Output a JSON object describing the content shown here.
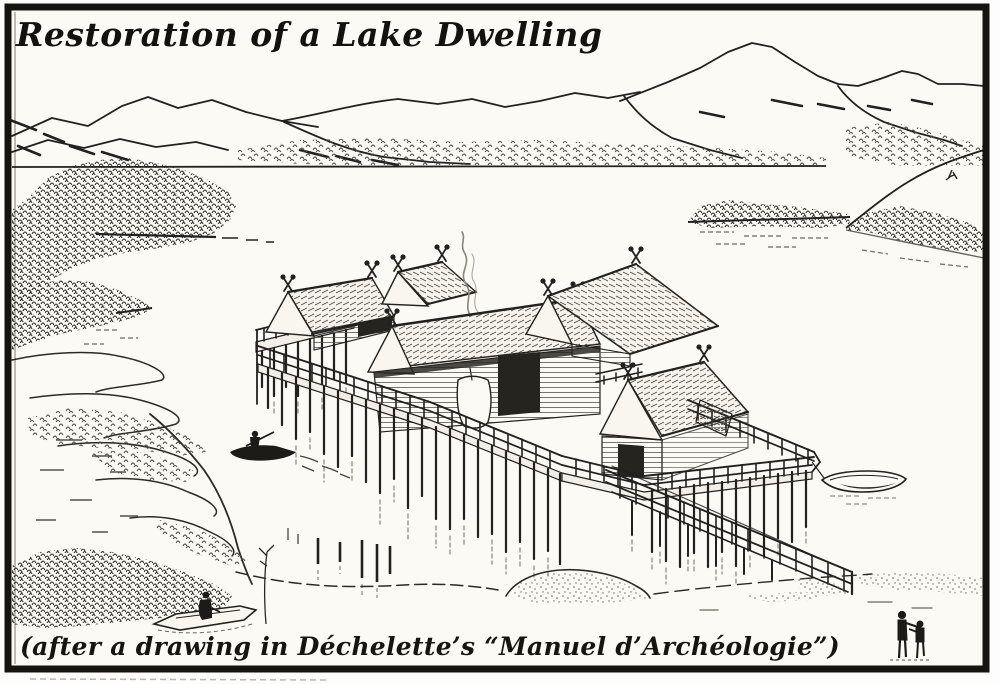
{
  "figure": {
    "title": "Restoration of a Lake Dwelling",
    "caption": "(after a drawing in Déchelette’s “Manuel d’Archéologie”)"
  },
  "colors": {
    "ink": "#23211d",
    "paper": "#fbfaf4",
    "reflection_gray": "#918e84"
  }
}
